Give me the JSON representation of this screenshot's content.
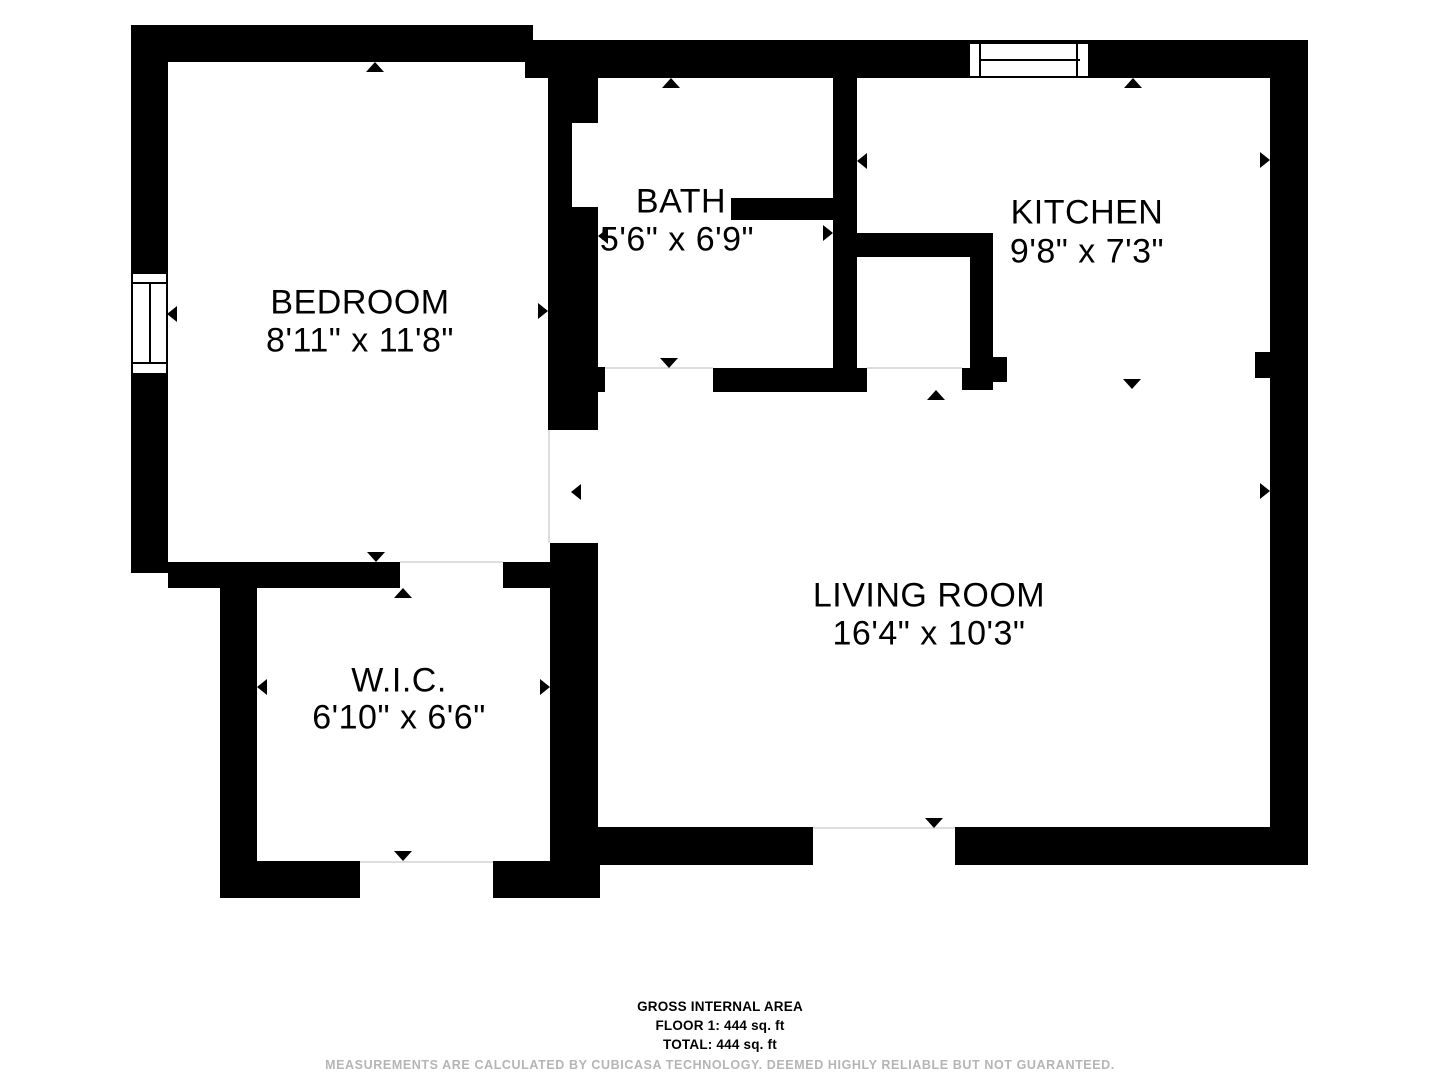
{
  "floorplan": {
    "rooms": [
      {
        "name": "BEDROOM",
        "dimensions": "8'11\" x 11'8\""
      },
      {
        "name": "BATH",
        "dimensions": "5'6\" x 6'9\""
      },
      {
        "name": "KITCHEN",
        "dimensions": "9'8\" x 7'3\""
      },
      {
        "name": "LIVING ROOM",
        "dimensions": "16'4\" x 10'3\""
      },
      {
        "name": "W.I.C.",
        "dimensions": "6'10\" x 6'6\""
      }
    ],
    "windows": [
      {
        "name": "bedroom-window",
        "wall": "left"
      },
      {
        "name": "kitchen-window",
        "wall": "top"
      }
    ],
    "footer": {
      "area_title": "GROSS INTERNAL AREA",
      "floor_line": "FLOOR 1: 444 sq. ft",
      "total_line": "TOTAL: 444 sq. ft",
      "disclaimer": "MEASUREMENTS ARE CALCULATED BY CUBICASA TECHNOLOGY. DEEMED HIGHLY RELIABLE BUT NOT GUARANTEED."
    },
    "colors": {
      "wall": "#000000",
      "background": "#ffffff",
      "open_boundary": "#dedede",
      "disclaimer_text": "#b5b5b5"
    }
  }
}
